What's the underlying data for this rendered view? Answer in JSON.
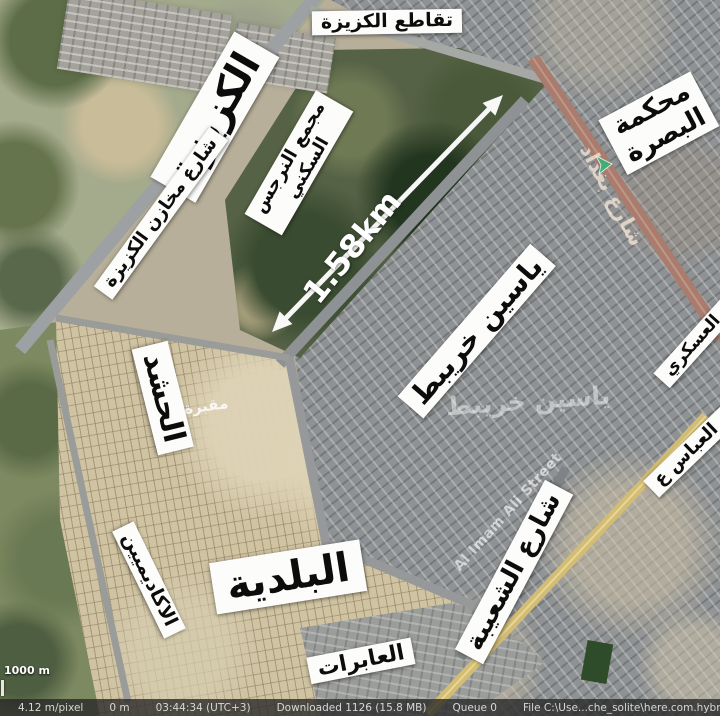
{
  "map": {
    "scale_label": "1000 m",
    "distance_measurement": "1.58km",
    "labels": {
      "kzeiza": "الكزيزة",
      "kzeiza_intersection": "تقاطع الكزيزة",
      "kzeiza_warehouses_street": "شارع مخازن الكزيزة",
      "narjis_complex_line1": "مجمع النرجس",
      "narjis_complex_line2": "السكني",
      "basra_court_line1": "محكمة",
      "basra_court_line2": "البصرة",
      "baghdad_street": "شارع بغداد",
      "yaseen_khuraibit": "ياسين خريبط",
      "yaseen_khuraibit_basemap": "ياسين خريبط",
      "hashd_cemetery": "الحشد",
      "cemetery_basemap": "مقبرة",
      "military_section": "المقطع العسكري",
      "abbas_district": "حي العباس ع",
      "shuaiba_street": "شارع الشعيبة",
      "imam_ali_street": "Al Imam Ali Street",
      "baladiya": "البلدية",
      "academics": "الاكاديميين",
      "aabirat": "العابرات"
    }
  },
  "status_bar": {
    "resolution": "4.12 m/pixel",
    "elevation": "0 m",
    "time": "03:44:34 (UTC+3)",
    "downloaded": "Downloaded 1126 (15.8 MB)",
    "queue": "Queue 0",
    "file": "File C:\\Use...che_solite\\here.com.hybrid"
  }
}
